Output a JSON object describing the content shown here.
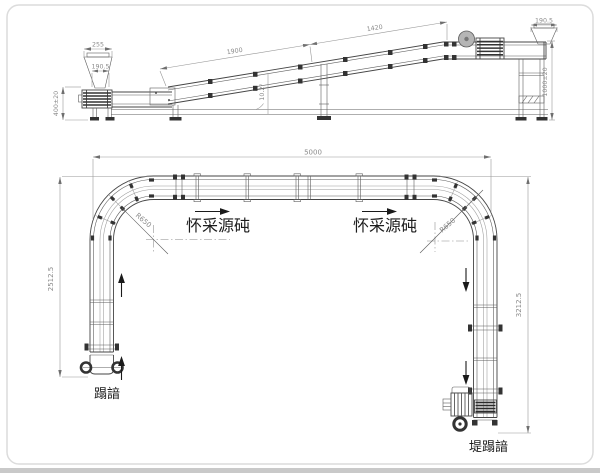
{
  "drawing": {
    "elevation": {
      "dim_hopper_outer": "255",
      "dim_hopper_inner_left": "190.5",
      "dim_infeed_height": "400±20",
      "dim_incline_lower": "1900",
      "dim_incline_upper": "1420",
      "dim_incline_angle": "10.2°",
      "dim_hopper_inner_right": "190.5",
      "dim_discharge_height": "1000±20"
    },
    "plan": {
      "dim_overall_width": "5000",
      "dim_left_leg_length": "2512.5",
      "dim_right_leg_length": "3212.5",
      "radius_left_bend": "R650",
      "radius_right_bend": "R650",
      "watermark_left": "怀采源砘",
      "watermark_right": "怀采源砘",
      "label_infeed_end": "蹋諳",
      "label_discharge_end": "堤蹋諳"
    }
  }
}
